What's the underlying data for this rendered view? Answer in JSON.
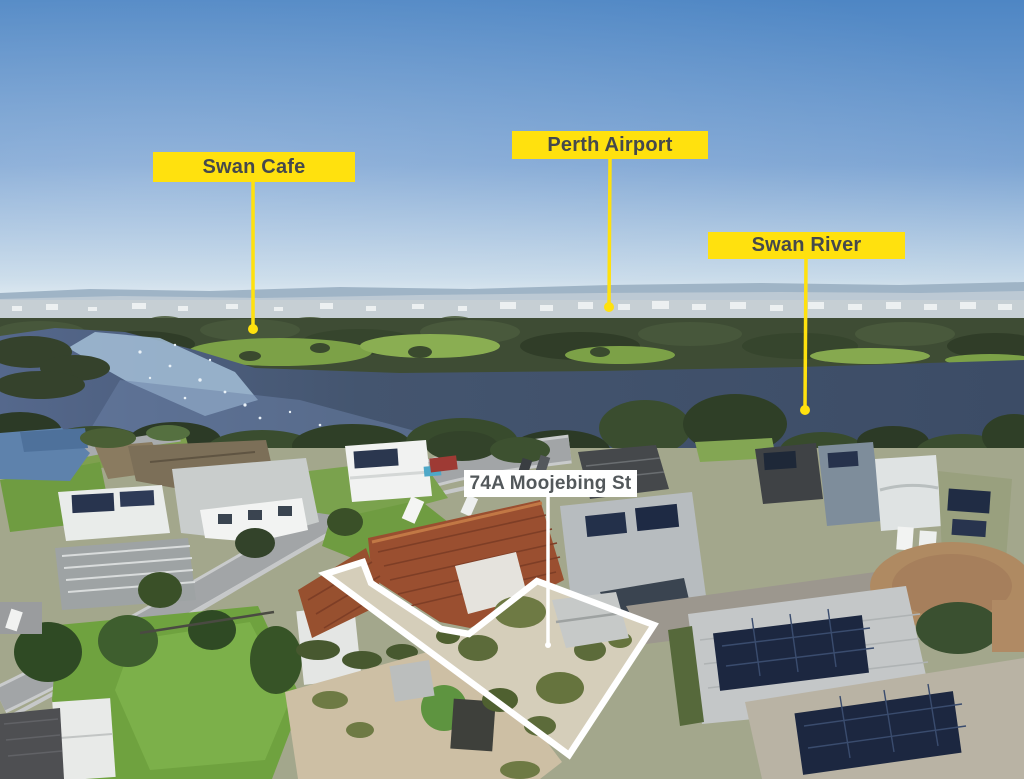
{
  "annotations": [
    {
      "id": "swan-cafe",
      "label": "Swan Cafe",
      "style": "yellow"
    },
    {
      "id": "perth-airport",
      "label": "Perth Airport",
      "style": "yellow"
    },
    {
      "id": "swan-river",
      "label": "Swan River",
      "style": "yellow"
    },
    {
      "id": "property",
      "label": "74A Moojebing St",
      "style": "white"
    }
  ],
  "colors": {
    "label_yellow": "#FFE10E",
    "label_text_dark": "#45494C",
    "label_white": "#FFFFFF",
    "boundary_white": "#FFFFFF"
  }
}
